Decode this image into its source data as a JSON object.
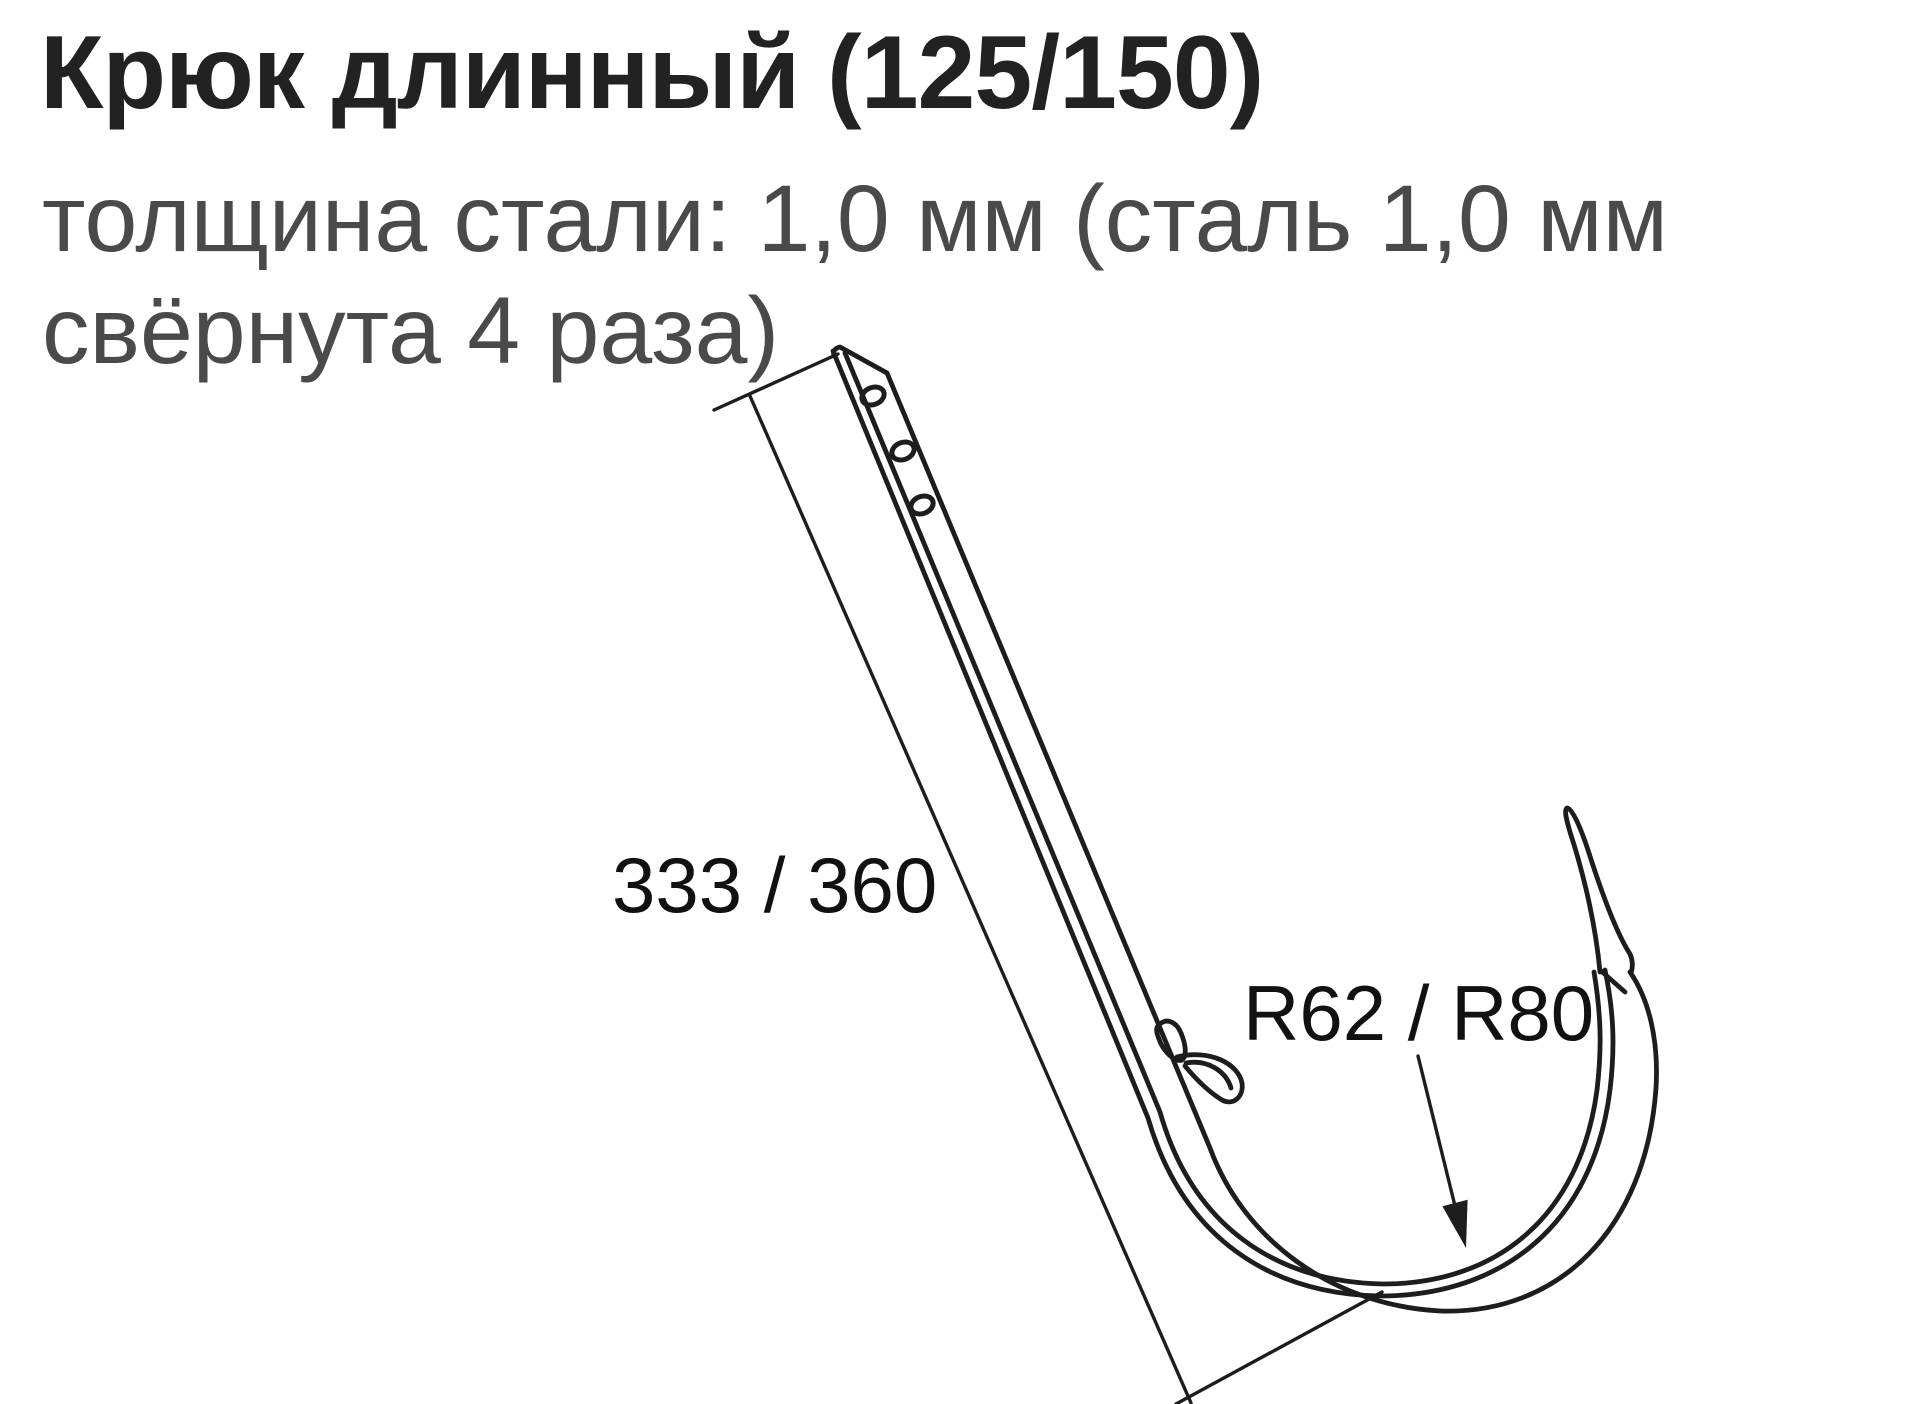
{
  "title": "Крюк длинный (125/150)",
  "subtitle": {
    "line1": "толщина стали: 1,0 мм (сталь 1,0 мм",
    "line2": "свёрнута 4 раза)"
  },
  "diagram": {
    "type": "technical line drawing",
    "subject": "long gutter hook bracket with three mounting holes, snap clip and curved gutter bowl with lip",
    "hole_count": 3,
    "labels": {
      "length": "333 / 360",
      "radius": "R62 / R80"
    }
  },
  "theme": {
    "bg": "#ffffff",
    "line": "#1d1d1d",
    "title-color": "#222222",
    "subtitle-color": "#4a4a4a",
    "label-color": "#111111"
  }
}
